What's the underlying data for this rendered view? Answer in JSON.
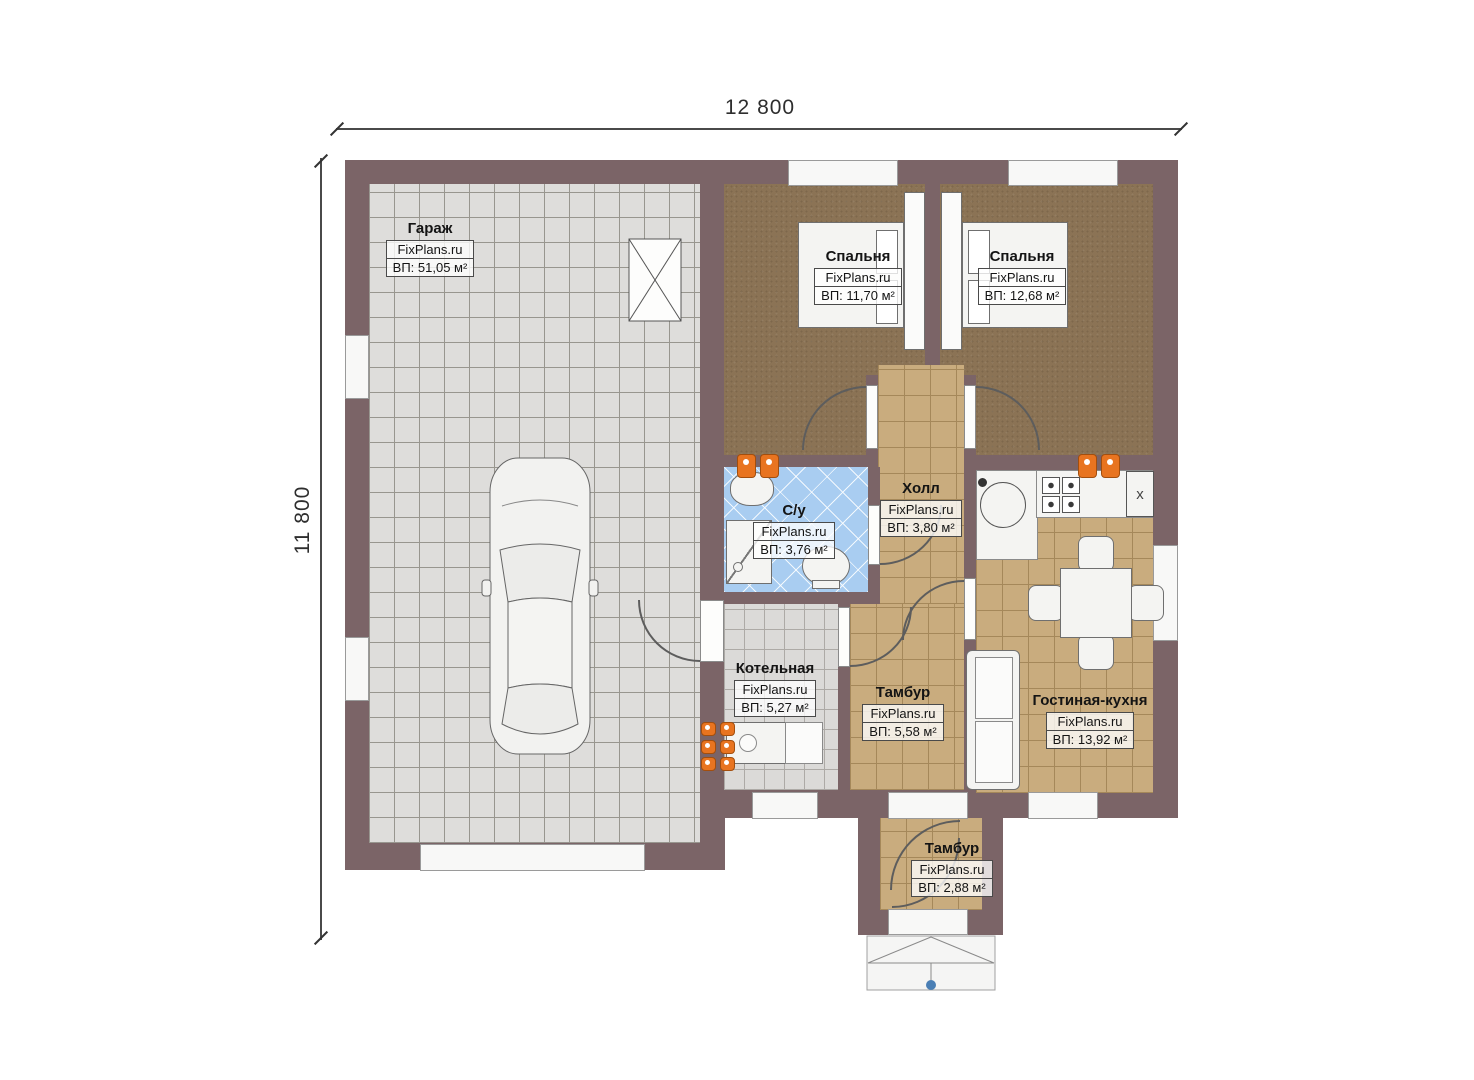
{
  "watermark": "FixPlans.ru",
  "dimensions": {
    "top": "12 800",
    "left": "11 800"
  },
  "rooms": [
    {
      "id": "garage",
      "name": "Гараж",
      "area": "ВП: 51,05 м²"
    },
    {
      "id": "bedroom-1",
      "name": "Спальня",
      "area": "ВП: 11,70 м²"
    },
    {
      "id": "bedroom-2",
      "name": "Спальня",
      "area": "ВП: 12,68 м²"
    },
    {
      "id": "bathroom",
      "name": "С/у",
      "area": "ВП: 3,76 м²"
    },
    {
      "id": "hall",
      "name": "Холл",
      "area": "ВП: 3,80 м²"
    },
    {
      "id": "boiler-room",
      "name": "Котельная",
      "area": "ВП: 5,27 м²"
    },
    {
      "id": "vestibule-inner",
      "name": "Тамбур",
      "area": "ВП: 5,58 м²"
    },
    {
      "id": "living-kitchen",
      "name": "Гостиная-кухня",
      "area": "ВП: 13,92 м²"
    },
    {
      "id": "vestibule-entry",
      "name": "Тамбур",
      "area": "ВП: 2,88 м²"
    }
  ],
  "appliances": {
    "fridge_label": "x"
  },
  "icons": [
    "car-icon",
    "bed-icon",
    "sofa-icon",
    "dining-table-icon",
    "stove-icon",
    "kitchen-sink-icon",
    "fridge-icon",
    "toilet-icon",
    "washbasin-icon",
    "washing-machine-icon",
    "boiler-unit-icon",
    "radiator-icon",
    "vent-shaft-icon",
    "porch-icon",
    "entry-point-marker"
  ],
  "colors": {
    "wall": "#7b6467",
    "garage_floor": "#dedddb",
    "bedroom_floor": "#8b7355",
    "tile_floor": "#c9ac7e",
    "bathroom_floor": "#a9cdf1",
    "boiler_floor": "#dbdad8",
    "radiator": "#e87420",
    "dimension_text": "#2e2e2e",
    "entry_marker": "#4a7fb5"
  }
}
